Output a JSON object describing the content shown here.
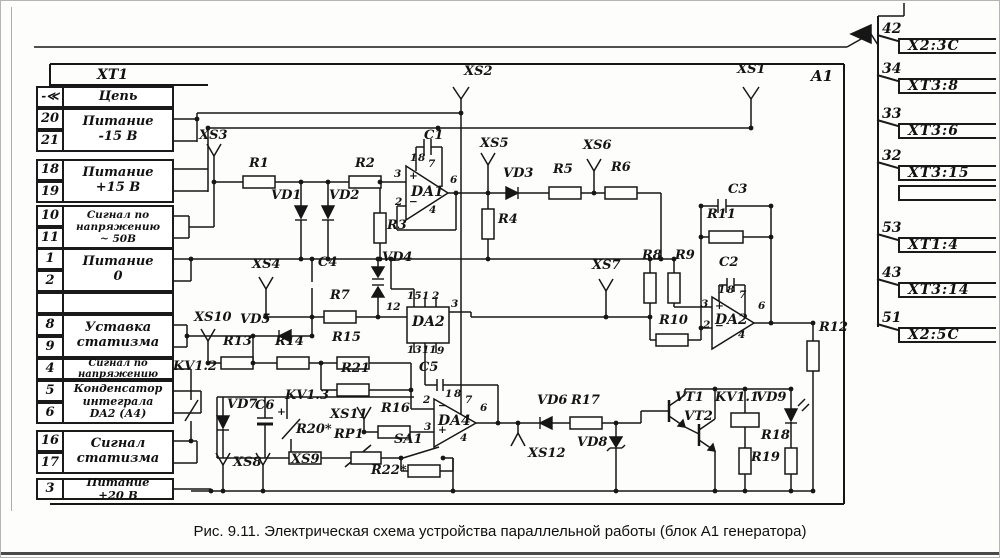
{
  "caption": "Рис. 9.11. Электрическая схема устройства параллельной работы (блок А1 генератора)",
  "block_label": "A1",
  "connector_table": {
    "title": "XT1",
    "col_header": "Цепь",
    "arrow": "-≪",
    "groups": [
      {
        "top": 107,
        "pins": [
          "20",
          "21"
        ],
        "label": "Питание\n-15 В",
        "fs": 13
      },
      {
        "top": 158,
        "pins": [
          "18",
          "19"
        ],
        "label": "Питание\n+15 В",
        "fs": 13
      },
      {
        "top": 204,
        "pins": [
          "10",
          "11"
        ],
        "label": "Сигнал по\nнапряжению\n~ 50В",
        "fs": 10.5
      },
      {
        "top": 247,
        "pins": [
          "1",
          "2"
        ],
        "label": "Питание\n0",
        "fs": 13
      },
      {
        "top": 291,
        "pins": [
          ""
        ],
        "label": "",
        "fs": 13
      },
      {
        "top": 313,
        "pins": [
          "8",
          "9"
        ],
        "label": "Уставка\nстатизма",
        "fs": 13
      },
      {
        "top": 357,
        "pins": [
          "4"
        ],
        "label": "Сигнал по\nнапряжению",
        "fs": 10
      },
      {
        "top": 379,
        "pins": [
          "5",
          "6"
        ],
        "label": "Конденсатор\nинтеграла\nDA2 (А4)",
        "fs": 11
      },
      {
        "top": 429,
        "pins": [
          "16",
          "17"
        ],
        "label": "Сигнал\nстатизма",
        "fs": 13
      },
      {
        "top": 477,
        "pins": [
          "3"
        ],
        "label": "Питание\n+20 В",
        "fs": 11.5
      }
    ]
  },
  "terminals": {
    "items": [
      {
        "pin": "42",
        "label": "X2:3C",
        "ny": 20,
        "by": 37
      },
      {
        "pin": "34",
        "label": "XT3:8",
        "ny": 60,
        "by": 77
      },
      {
        "pin": "33",
        "label": "XT3:6",
        "ny": 105,
        "by": 122
      },
      {
        "pin": "32",
        "label": "XT3:15",
        "ny": 147,
        "by": 164
      },
      {
        "pin": "",
        "label": "",
        "ny": null,
        "by": 184
      },
      {
        "pin": "53",
        "label": "XT1:4",
        "ny": 219,
        "by": 236
      },
      {
        "pin": "43",
        "label": "XT3:14",
        "ny": 264,
        "by": 281
      },
      {
        "pin": "51",
        "label": "X2:5C",
        "ny": 309,
        "by": 326
      }
    ]
  },
  "labels": [
    {
      "t": "XS2",
      "x": 463,
      "y": 64
    },
    {
      "t": "XS1",
      "x": 736,
      "y": 62
    },
    {
      "t": "XS3",
      "x": 198,
      "y": 128
    },
    {
      "t": "R1",
      "x": 248,
      "y": 156
    },
    {
      "t": "R2",
      "x": 354,
      "y": 156
    },
    {
      "t": "C1",
      "x": 423,
      "y": 128
    },
    {
      "t": "VD1",
      "x": 270,
      "y": 188
    },
    {
      "t": "VD2",
      "x": 328,
      "y": 188
    },
    {
      "t": "R3",
      "x": 386,
      "y": 218
    },
    {
      "t": "XS5",
      "x": 479,
      "y": 136
    },
    {
      "t": "VD3",
      "x": 502,
      "y": 166
    },
    {
      "t": "R5",
      "x": 552,
      "y": 162
    },
    {
      "t": "XS6",
      "x": 582,
      "y": 138
    },
    {
      "t": "R6",
      "x": 610,
      "y": 160
    },
    {
      "t": "R4",
      "x": 497,
      "y": 212
    },
    {
      "t": "C3",
      "x": 727,
      "y": 182
    },
    {
      "t": "R11",
      "x": 706,
      "y": 207
    },
    {
      "t": "C2",
      "x": 718,
      "y": 255
    },
    {
      "t": "R8",
      "x": 641,
      "y": 248
    },
    {
      "t": "R9",
      "x": 674,
      "y": 248
    },
    {
      "t": "R10",
      "x": 658,
      "y": 313
    },
    {
      "t": "R12",
      "x": 818,
      "y": 320
    },
    {
      "t": "XS7",
      "x": 591,
      "y": 258
    },
    {
      "t": "XS4",
      "x": 251,
      "y": 257
    },
    {
      "t": "C4",
      "x": 317,
      "y": 255
    },
    {
      "t": "VD4",
      "x": 381,
      "y": 250
    },
    {
      "t": "R7",
      "x": 329,
      "y": 288
    },
    {
      "t": "12",
      "x": 385,
      "y": 301,
      "c": "pin"
    },
    {
      "t": "XS10",
      "x": 193,
      "y": 310
    },
    {
      "t": "VD5",
      "x": 239,
      "y": 312
    },
    {
      "t": "R13",
      "x": 222,
      "y": 334
    },
    {
      "t": "R14",
      "x": 274,
      "y": 334
    },
    {
      "t": "R15",
      "x": 331,
      "y": 330
    },
    {
      "t": "KV1.2",
      "x": 172,
      "y": 359
    },
    {
      "t": "R21",
      "x": 340,
      "y": 361
    },
    {
      "t": "VD7",
      "x": 226,
      "y": 397
    },
    {
      "t": "C6",
      "x": 254,
      "y": 398
    },
    {
      "t": "+",
      "x": 276,
      "y": 406,
      "c": "pin"
    },
    {
      "t": "KV1.3",
      "x": 284,
      "y": 388
    },
    {
      "t": "R20*",
      "x": 295,
      "y": 422
    },
    {
      "t": "RP1",
      "x": 333,
      "y": 427
    },
    {
      "t": "XS11",
      "x": 329,
      "y": 407
    },
    {
      "t": "R16",
      "x": 380,
      "y": 401
    },
    {
      "t": "SA1",
      "x": 393,
      "y": 432
    },
    {
      "t": "R22*",
      "x": 370,
      "y": 463
    },
    {
      "t": "XS8",
      "x": 232,
      "y": 455
    },
    {
      "t": "XS9",
      "x": 290,
      "y": 452
    },
    {
      "t": "C5",
      "x": 418,
      "y": 360
    },
    {
      "t": "XS12",
      "x": 527,
      "y": 446
    },
    {
      "t": "VD6",
      "x": 536,
      "y": 393
    },
    {
      "t": "R17",
      "x": 570,
      "y": 393
    },
    {
      "t": "VD8",
      "x": 576,
      "y": 435
    },
    {
      "t": "VT1",
      "x": 674,
      "y": 390
    },
    {
      "t": "VT2",
      "x": 683,
      "y": 409
    },
    {
      "t": "KV1.1",
      "x": 714,
      "y": 390
    },
    {
      "t": "VD9",
      "x": 755,
      "y": 390
    },
    {
      "t": "R18",
      "x": 760,
      "y": 428
    },
    {
      "t": "R19",
      "x": 750,
      "y": 450
    },
    {
      "t": "DA1",
      "x": 410,
      "y": 184,
      "c": "ic"
    },
    {
      "t": "DA2",
      "x": 411,
      "y": 314,
      "c": "ic"
    },
    {
      "t": "DA2",
      "x": 714,
      "y": 312,
      "c": "ic"
    },
    {
      "t": "DA4",
      "x": 437,
      "y": 413,
      "c": "ic"
    },
    {
      "t": "3",
      "x": 393,
      "y": 168,
      "c": "pin"
    },
    {
      "t": "2",
      "x": 394,
      "y": 196,
      "c": "pin"
    },
    {
      "t": "6",
      "x": 449,
      "y": 174,
      "c": "pin"
    },
    {
      "t": "4",
      "x": 428,
      "y": 204,
      "c": "pin"
    },
    {
      "t": "7",
      "x": 427,
      "y": 158,
      "c": "pin"
    },
    {
      "t": "1",
      "x": 409,
      "y": 152,
      "c": "pin"
    },
    {
      "t": "8",
      "x": 417,
      "y": 152,
      "c": "pin"
    },
    {
      "t": "+",
      "x": 408,
      "y": 170,
      "c": "pin"
    },
    {
      "t": "−",
      "x": 408,
      "y": 196,
      "c": "pin"
    },
    {
      "t": "15",
      "x": 406,
      "y": 290,
      "c": "pin"
    },
    {
      "t": "1",
      "x": 421,
      "y": 290,
      "c": "pin"
    },
    {
      "t": "2",
      "x": 431,
      "y": 290,
      "c": "pin"
    },
    {
      "t": "3",
      "x": 450,
      "y": 298,
      "c": "pin"
    },
    {
      "t": "13",
      "x": 406,
      "y": 344,
      "c": "pin"
    },
    {
      "t": "11",
      "x": 421,
      "y": 344,
      "c": "pin"
    },
    {
      "t": "9",
      "x": 436,
      "y": 345,
      "c": "pin"
    },
    {
      "t": "3",
      "x": 700,
      "y": 298,
      "c": "pin"
    },
    {
      "t": "2",
      "x": 702,
      "y": 319,
      "c": "pin"
    },
    {
      "t": "6",
      "x": 757,
      "y": 300,
      "c": "pin"
    },
    {
      "t": "4",
      "x": 737,
      "y": 329,
      "c": "pin"
    },
    {
      "t": "7",
      "x": 738,
      "y": 289,
      "c": "pin"
    },
    {
      "t": "1",
      "x": 717,
      "y": 284,
      "c": "pin"
    },
    {
      "t": "8",
      "x": 726,
      "y": 284,
      "c": "pin"
    },
    {
      "t": "+",
      "x": 714,
      "y": 300,
      "c": "pin"
    },
    {
      "t": "−",
      "x": 714,
      "y": 320,
      "c": "pin"
    },
    {
      "t": "2",
      "x": 422,
      "y": 394,
      "c": "pin"
    },
    {
      "t": "3",
      "x": 423,
      "y": 421,
      "c": "pin"
    },
    {
      "t": "6",
      "x": 479,
      "y": 402,
      "c": "pin"
    },
    {
      "t": "4",
      "x": 459,
      "y": 432,
      "c": "pin"
    },
    {
      "t": "7",
      "x": 464,
      "y": 394,
      "c": "pin"
    },
    {
      "t": "1",
      "x": 444,
      "y": 388,
      "c": "pin"
    },
    {
      "t": "8",
      "x": 453,
      "y": 388,
      "c": "pin"
    },
    {
      "t": "−",
      "x": 437,
      "y": 400,
      "c": "pin"
    },
    {
      "t": "+",
      "x": 437,
      "y": 424,
      "c": "pin"
    }
  ]
}
